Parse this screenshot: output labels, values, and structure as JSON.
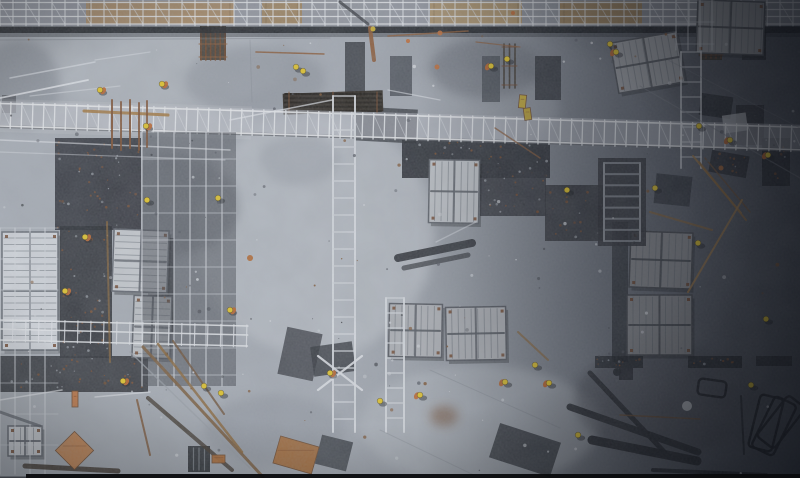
{
  "meta": {
    "description": "Aerial top-down photograph of a construction site: concrete slabs, scaffolding walkways, white formwork panel stacks, rust rebar bundles, timber, and workers wearing yellow hard hats and orange vests; right side of the site is in deep shadow",
    "width": 800,
    "height": 478
  },
  "palette": {
    "concrete_light": "#aab0b8",
    "concrete_dark_right": "#454a53",
    "shadow_band": "#14171c",
    "formwork_white": "#d6dae0",
    "scaffold_white": "#e7eaef",
    "helmet_yellow": "#e8c822",
    "vest_orange": "#bf6226",
    "rust": "#7c4a28",
    "timber_tan": "#a5793f",
    "steel_dark": "#24272d"
  },
  "scene": {
    "seed": 11,
    "speckle_count": 170,
    "stains": [
      [
        315,
        235,
        120,
        120,
        "#c6cbd2",
        0.5
      ],
      [
        165,
        65,
        120,
        45,
        "#bac0c7",
        0.45
      ],
      [
        480,
        425,
        120,
        60,
        "#b9bfc6",
        0.5
      ],
      [
        470,
        108,
        90,
        38,
        "#a9afb8",
        0.4
      ],
      [
        35,
        215,
        60,
        90,
        "#a9afb8",
        0.35
      ],
      [
        350,
        255,
        50,
        100,
        "#b6bcc3",
        0.4
      ],
      [
        255,
        80,
        70,
        35,
        "#878d97",
        0.5
      ],
      [
        20,
        85,
        40,
        45,
        "#7a808a",
        0.5
      ],
      [
        485,
        68,
        55,
        30,
        "#5d626c",
        0.45
      ],
      [
        170,
        205,
        70,
        50,
        "#5a5f68",
        0.35
      ],
      [
        275,
        430,
        70,
        35,
        "#8a909a",
        0.45
      ],
      [
        665,
        400,
        90,
        55,
        "#3f434c",
        0.4
      ],
      [
        735,
        85,
        70,
        40,
        "#454a53",
        0.4
      ],
      [
        444,
        416,
        14,
        10,
        "#6e4526",
        0.55
      ],
      [
        628,
        20,
        60,
        30,
        "#6a707a",
        0.4
      ],
      [
        300,
        160,
        40,
        25,
        "#999fa8",
        0.5
      ]
    ],
    "patches": [
      [
        55,
        138,
        86,
        92,
        0,
        "#2b2e35",
        0.92,
        1
      ],
      [
        60,
        226,
        52,
        132,
        0,
        "#22252b",
        0.88,
        1
      ],
      [
        148,
        238,
        26,
        94,
        0,
        "#24272d",
        0.8,
        0
      ],
      [
        345,
        42,
        20,
        54,
        0,
        "#2f3238",
        0.85,
        0
      ],
      [
        390,
        56,
        22,
        40,
        0,
        "#3f444c",
        0.8,
        0
      ],
      [
        482,
        56,
        18,
        46,
        0,
        "#3f444c",
        0.75,
        0
      ],
      [
        535,
        56,
        26,
        44,
        0,
        "#2e3138",
        0.88,
        0
      ],
      [
        355,
        108,
        62,
        34,
        3,
        "#31343b",
        0.8,
        0
      ],
      [
        402,
        140,
        148,
        38,
        0,
        "#24272e",
        0.92,
        1
      ],
      [
        480,
        164,
        66,
        52,
        0,
        "#2b2e35",
        0.85,
        1
      ],
      [
        282,
        330,
        36,
        48,
        12,
        "#33363d",
        0.8,
        0
      ],
      [
        312,
        344,
        42,
        30,
        -8,
        "#2c2f36",
        0.8,
        0
      ],
      [
        0,
        356,
        148,
        36,
        0,
        "#2a2d33",
        0.88,
        1
      ],
      [
        188,
        446,
        22,
        26,
        0,
        "#26292f",
        0.92,
        2
      ],
      [
        318,
        438,
        32,
        30,
        14,
        "#3a3e45",
        0.85,
        0
      ],
      [
        493,
        432,
        64,
        36,
        18,
        "#33373e",
        0.9,
        0
      ],
      [
        612,
        222,
        16,
        140,
        0,
        "#26292f",
        0.75,
        0
      ],
      [
        700,
        95,
        32,
        22,
        8,
        "#202329",
        0.85,
        0
      ],
      [
        736,
        105,
        28,
        40,
        0,
        "#24272d",
        0.85,
        0
      ],
      [
        742,
        28,
        24,
        32,
        0,
        "#25282e",
        0.85,
        0
      ],
      [
        762,
        138,
        28,
        48,
        0,
        "#1f2228",
        0.85,
        1
      ],
      [
        710,
        153,
        38,
        22,
        10,
        "#1f2228",
        0.8,
        1
      ],
      [
        655,
        175,
        36,
        30,
        6,
        "#2a2d34",
        0.75,
        0
      ],
      [
        545,
        185,
        60,
        56,
        0,
        "#2a2d33",
        0.85,
        1
      ],
      [
        595,
        356,
        48,
        12,
        0,
        "#1d2026",
        0.8,
        1
      ],
      [
        688,
        356,
        54,
        12,
        0,
        "#1d2026",
        0.8,
        1
      ],
      [
        756,
        356,
        36,
        10,
        0,
        "#1d2026",
        0.75,
        0
      ],
      [
        200,
        26,
        26,
        34,
        0,
        "#322a1e",
        0.85,
        0
      ],
      [
        283,
        92,
        100,
        21,
        -2,
        "#241e16",
        0.95,
        0
      ],
      [
        700,
        26,
        22,
        34,
        0,
        "#2c2418",
        0.8,
        0
      ],
      [
        0,
        0,
        15,
        9,
        0,
        "#121417",
        0.9,
        0
      ],
      [
        619,
        368,
        14,
        12,
        0,
        "#22252b",
        0.85,
        0
      ],
      [
        723,
        114,
        24,
        18,
        -8,
        "#c9cdd3",
        0.7,
        0
      ],
      [
        2,
        95,
        14,
        18,
        0,
        "#383c43",
        0.6,
        0
      ]
    ],
    "combs": [
      [
        201,
        28,
        24,
        32,
        "v",
        6,
        "#6e4124",
        "#8a5630"
      ],
      [
        285,
        94,
        96,
        17,
        "h",
        5,
        "#191510",
        "#7c4a28"
      ],
      [
        701,
        28,
        20,
        30,
        "v",
        5,
        "#5e3a20",
        "#7c4a28"
      ],
      [
        504,
        44,
        11,
        44,
        "v",
        3,
        "#3a3228",
        "#6e4124"
      ]
    ],
    "walkway_top": {
      "h": 26,
      "rails": [
        2.5,
        9.5,
        16.5,
        24
      ],
      "post_gap": 13,
      "base": "#8f949d",
      "planks": [
        [
          86,
          148,
          "#a8865a"
        ],
        [
          262,
          40,
          "#9d7f52"
        ],
        [
          430,
          92,
          "#b0915f"
        ],
        [
          560,
          82,
          "#a07e4e"
        ],
        [
          698,
          44,
          "#8f7348"
        ]
      ]
    },
    "walkway_mid": {
      "y": 101,
      "h": 27,
      "rot": 1.7,
      "post_gap": 11,
      "rails": [
        103.5,
        126
      ],
      "bright_w": 252
    },
    "walkway_left": {
      "x": 0,
      "y": 318,
      "w": 248,
      "rot": 1.4,
      "post_gap": 13,
      "rails": [
        320,
        329,
        340
      ]
    },
    "stacks": [
      [
        2,
        232,
        56,
        118,
        0,
        1,
        "h"
      ],
      [
        113,
        230,
        55,
        62,
        2,
        0.95,
        "h"
      ],
      [
        133,
        296,
        38,
        62,
        2,
        0.9,
        "h"
      ],
      [
        8,
        426,
        34,
        30,
        0,
        0.95,
        "v"
      ],
      [
        429,
        160,
        50,
        63,
        1,
        0.9,
        "v"
      ],
      [
        389,
        304,
        53,
        53,
        1,
        0.82,
        "v"
      ],
      [
        446,
        307,
        60,
        53,
        -1,
        0.82,
        "v"
      ],
      [
        630,
        232,
        62,
        56,
        2,
        0.65,
        "v"
      ],
      [
        627,
        295,
        65,
        60,
        0,
        0.65,
        "v"
      ],
      [
        614,
        37,
        67,
        51,
        -10,
        0.75,
        "v"
      ],
      [
        697,
        1,
        67,
        53,
        2,
        0.7,
        "v"
      ]
    ],
    "towers": [
      [
        142,
        132,
        94,
        254,
        16,
        27,
        0.75,
        "#3a3e45"
      ],
      [
        0,
        228,
        58,
        246,
        15,
        31,
        0.7,
        ""
      ],
      [
        676,
        0,
        38,
        50,
        12,
        22,
        0.6,
        ""
      ]
    ],
    "ladders": [
      [
        333,
        96,
        22,
        336,
        17,
        0.9
      ],
      [
        386,
        298,
        18,
        134,
        15,
        0.85
      ],
      [
        681,
        52,
        20,
        116,
        15,
        0.65
      ]
    ],
    "stair": {
      "back": [
        598,
        158,
        48,
        88
      ],
      "x": 604,
      "y": 163,
      "w": 36,
      "h": 78,
      "steps": 7
    },
    "lines": [
      [
        0,
        98,
        88,
        80,
        1.8,
        "#e7eaef",
        0.85
      ],
      [
        0,
        140,
        230,
        150,
        1.5,
        "#e7eaef",
        0.6
      ],
      [
        0,
        152,
        225,
        160,
        1.2,
        "#dfe3e9",
        0.45
      ],
      [
        230,
        120,
        332,
        100,
        1.5,
        "#e7eaef",
        0.7
      ],
      [
        10,
        78,
        95,
        62,
        1.5,
        "#dfe3e9",
        0.65
      ],
      [
        30,
        96,
        120,
        86,
        1.2,
        "#dfe3e9",
        0.5
      ],
      [
        95,
        60,
        150,
        52,
        1.2,
        "#dfe3e9",
        0.5
      ],
      [
        388,
        90,
        440,
        100,
        1.3,
        "#dfe3e9",
        0.6
      ],
      [
        0,
        400,
        62,
        390,
        1.5,
        "#e7eaef",
        0.7
      ],
      [
        95,
        397,
        150,
        392,
        1.4,
        "#e7eaef",
        0.6
      ],
      [
        318,
        356,
        362,
        390,
        2.2,
        "#e4e7ec",
        0.9
      ],
      [
        318,
        390,
        362,
        356,
        2.2,
        "#e4e7ec",
        0.9
      ],
      [
        436,
        242,
        476,
        222,
        1.3,
        "#dfe3e9",
        0.5
      ],
      [
        0,
        40,
        330,
        38,
        1,
        "#70757e",
        0.4
      ],
      [
        640,
        86,
        800,
        178,
        1.2,
        "#787d86",
        0.5
      ],
      [
        668,
        60,
        800,
        128,
        1,
        "#70757e",
        0.35
      ],
      [
        430,
        370,
        560,
        428,
        1,
        "#7e848d",
        0.4
      ],
      [
        380,
        430,
        480,
        478,
        1,
        "#7e848d",
        0.35
      ],
      [
        250,
        40,
        252,
        102,
        1,
        "#7a808a",
        0.3
      ],
      [
        570,
        407,
        698,
        452,
        7,
        "#24272d",
        0.92
      ],
      [
        590,
        373,
        668,
        456,
        5,
        "#24272d",
        0.9
      ],
      [
        592,
        440,
        697,
        461,
        9,
        "#202329",
        0.92
      ],
      [
        653,
        470,
        766,
        475,
        4,
        "#202329",
        0.9
      ],
      [
        398,
        258,
        472,
        243,
        8,
        "#26292f",
        0.9
      ],
      [
        404,
        268,
        468,
        255,
        5,
        "#2b2e34",
        0.7
      ],
      [
        25,
        466,
        118,
        471,
        5,
        "#362c22",
        0.85
      ],
      [
        148,
        398,
        232,
        470,
        4,
        "#3a3026",
        0.8
      ],
      [
        0,
        412,
        40,
        426,
        3,
        "#50555e",
        0.7
      ],
      [
        340,
        2,
        368,
        24,
        3,
        "#23262c",
        0.7
      ],
      [
        741,
        396,
        744,
        454,
        2,
        "#1d2026",
        0.8
      ],
      [
        143,
        347,
        263,
        477,
        3,
        "#7a5a38",
        0.9
      ],
      [
        158,
        344,
        242,
        452,
        2.5,
        "#8a6434",
        0.85
      ],
      [
        173,
        341,
        224,
        414,
        2,
        "#6b4c30",
        0.8
      ],
      [
        130,
        352,
        250,
        468,
        1.5,
        "#9aa0a8",
        0.7
      ],
      [
        84,
        111,
        168,
        115,
        3,
        "#a5793f",
        0.9
      ],
      [
        112,
        100,
        112,
        148,
        2,
        "#7c4a28",
        0.9
      ],
      [
        121,
        102,
        121,
        150,
        2,
        "#7c4a28",
        0.85
      ],
      [
        130,
        100,
        130,
        148,
        2,
        "#7c4a28",
        0.9
      ],
      [
        139,
        103,
        139,
        150,
        2,
        "#7c4a28",
        0.85
      ],
      [
        147,
        101,
        147,
        147,
        2,
        "#7c4a28",
        0.8
      ],
      [
        256,
        52,
        324,
        54,
        1.5,
        "#8a5630",
        0.85
      ],
      [
        388,
        36,
        468,
        31,
        1.5,
        "#8a5630",
        0.8
      ],
      [
        476,
        42,
        520,
        47,
        1.3,
        "#8a5630",
        0.7
      ],
      [
        370,
        28,
        374,
        60,
        4,
        "#8a5630",
        0.9
      ],
      [
        693,
        156,
        741,
        213,
        2,
        "#a5793f",
        0.85
      ],
      [
        699,
        162,
        746,
        220,
        2,
        "#8a6434",
        0.85
      ],
      [
        705,
        158,
        750,
        212,
        1.5,
        "#6b4c30",
        0.8
      ],
      [
        688,
        292,
        742,
        200,
        2,
        "#a5793f",
        0.8
      ],
      [
        650,
        212,
        712,
        230,
        2,
        "#8a6434",
        0.75
      ],
      [
        620,
        415,
        700,
        419,
        1.5,
        "#6b4c30",
        0.8
      ],
      [
        495,
        128,
        540,
        158,
        1.5,
        "#8a5630",
        0.7
      ],
      [
        137,
        400,
        150,
        455,
        2,
        "#7a4e2a",
        0.8
      ],
      [
        107,
        222,
        110,
        362,
        2,
        "#8a6434",
        0.7
      ],
      [
        518,
        332,
        548,
        360,
        2,
        "#8a6434",
        0.7
      ]
    ],
    "hframes": [
      [
        754,
        396,
        24,
        54,
        14
      ],
      [
        762,
        398,
        24,
        56,
        26
      ],
      [
        770,
        396,
        22,
        52,
        38
      ],
      [
        698,
        380,
        28,
        16,
        8
      ]
    ],
    "orange_rects": [
      [
        61,
        437,
        27,
        27,
        45,
        "#c8824a"
      ],
      [
        276,
        441,
        40,
        28,
        16,
        "#a96b34"
      ],
      [
        212,
        455,
        13,
        8,
        0,
        "#b06a30"
      ],
      [
        72,
        391,
        6,
        16,
        0,
        "#c87840"
      ],
      [
        519,
        95,
        7,
        13,
        6,
        "#d4b428"
      ],
      [
        524,
        108,
        7,
        12,
        -8,
        "#c8a824"
      ]
    ],
    "orange_dots": [
      [
        440,
        33,
        2.5,
        "#c06830"
      ],
      [
        408,
        41,
        2,
        "#c06830"
      ],
      [
        437,
        67,
        2.5,
        "#c06830"
      ],
      [
        250,
        258,
        3,
        "#b5662c"
      ],
      [
        721,
        168,
        2.5,
        "#a85f28"
      ],
      [
        373,
        29,
        2.5,
        "#d4b428"
      ],
      [
        513,
        13,
        2,
        "#c06830"
      ],
      [
        687,
        406,
        5,
        "#c6cad0"
      ],
      [
        617,
        372,
        4,
        "#23262c"
      ]
    ],
    "workers": [
      [
        100,
        90,
        1
      ],
      [
        162,
        84,
        1
      ],
      [
        146,
        126,
        1
      ],
      [
        296,
        67,
        0
      ],
      [
        303,
        71,
        0
      ],
      [
        147,
        200,
        0
      ],
      [
        218,
        198,
        0
      ],
      [
        85,
        237,
        1
      ],
      [
        65,
        291,
        1
      ],
      [
        230,
        310,
        1
      ],
      [
        123,
        381,
        1
      ],
      [
        204,
        386,
        0
      ],
      [
        221,
        393,
        0
      ],
      [
        330,
        373,
        1
      ],
      [
        380,
        401,
        0
      ],
      [
        420,
        395,
        1
      ],
      [
        535,
        365,
        0
      ],
      [
        549,
        383,
        1
      ],
      [
        578,
        435,
        0
      ],
      [
        505,
        382,
        1
      ],
      [
        507,
        59,
        0
      ],
      [
        491,
        66,
        1
      ],
      [
        610,
        44,
        0
      ],
      [
        616,
        52,
        1
      ],
      [
        699,
        126,
        0
      ],
      [
        730,
        140,
        1
      ],
      [
        768,
        155,
        1
      ],
      [
        567,
        190,
        0
      ],
      [
        655,
        188,
        0
      ],
      [
        698,
        243,
        0
      ],
      [
        766,
        319,
        0
      ],
      [
        751,
        385,
        0
      ]
    ]
  }
}
